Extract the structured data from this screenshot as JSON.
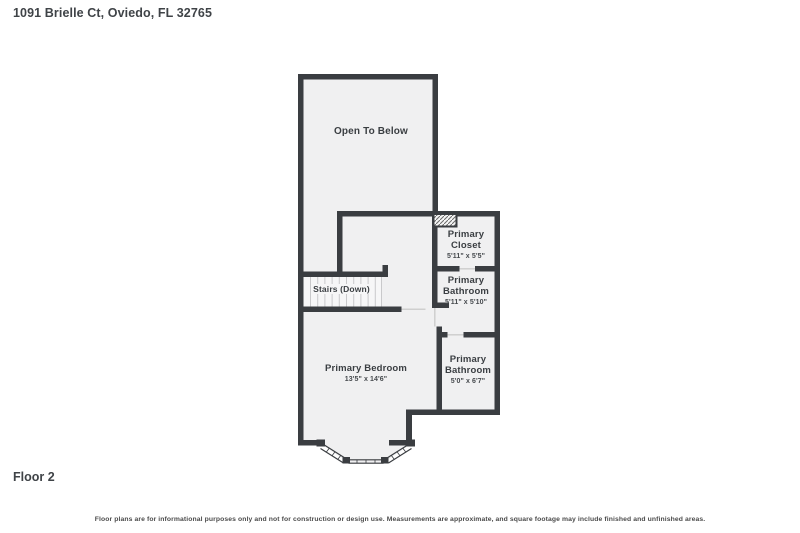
{
  "page": {
    "title": "1091 Brielle Ct, Oviedo, FL 32765",
    "floor_label": "Floor 2",
    "disclaimer": "Floor plans are for informational purposes only and not for construction or design use. Measurements are approximate, and square footage may include finished and unfinished areas."
  },
  "rooms": [
    {
      "name": "Open To Below",
      "dims": ""
    },
    {
      "name": "Primary Closet",
      "dims": "5'11\" x 5'5\""
    },
    {
      "name": "Primary Bathroom",
      "dims": "5'11\" x 5'10\""
    },
    {
      "name": "Stairs (Down)",
      "dims": ""
    },
    {
      "name": "Primary Bedroom",
      "dims": "13'5\" x 14'6\""
    },
    {
      "name": "Primary Bathroom",
      "dims": "5'0\" x 6'7\""
    }
  ],
  "colors": {
    "wall": "#3a3d41",
    "room_fill": "#f0f0f1",
    "stair_fill": "#f6f6f7",
    "tread_line": "#c9c9cb",
    "door_line": "#cfcfcf",
    "text": "#3c4043",
    "background": "#ffffff"
  }
}
